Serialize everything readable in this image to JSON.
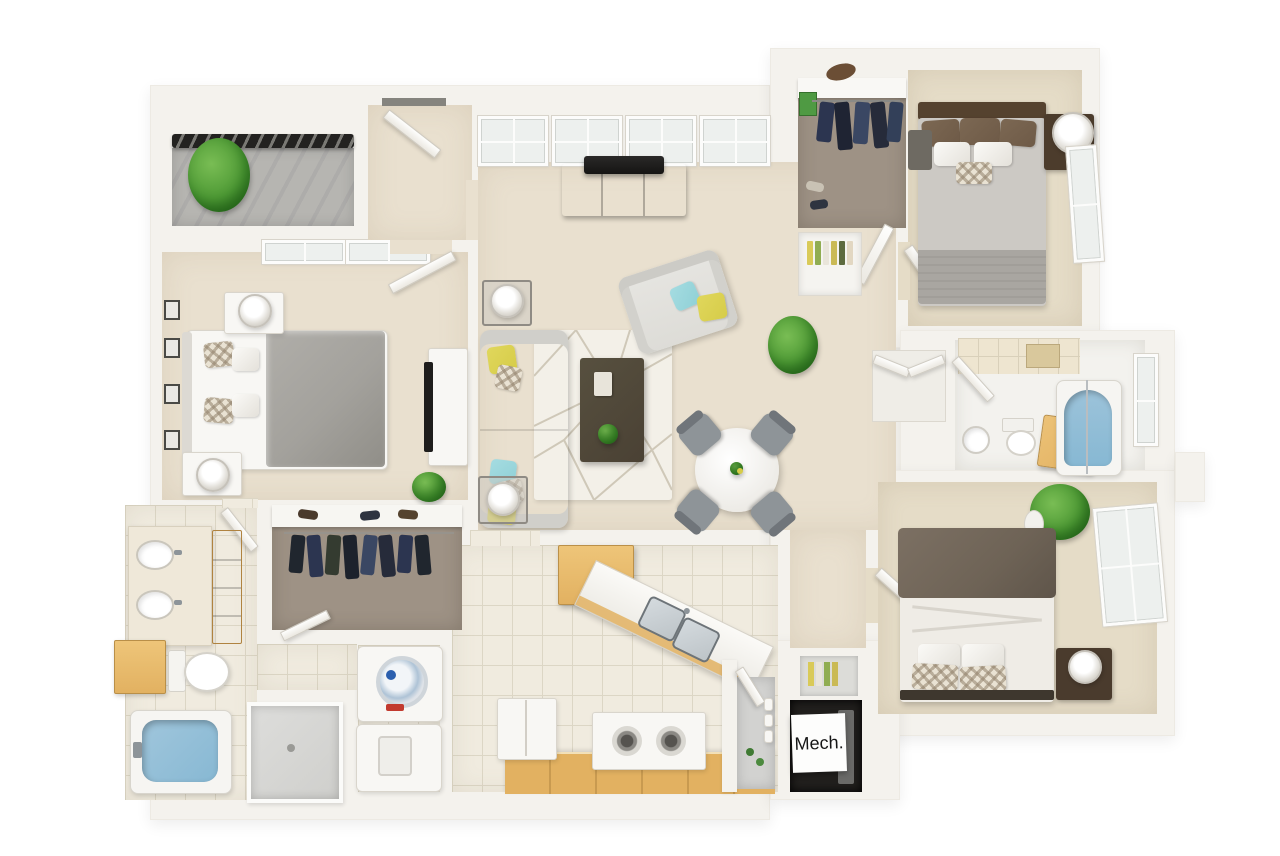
{
  "scene": {
    "type": "3d-apartment-floor-plan-rendering",
    "labels": {
      "mech_room": "Mech."
    },
    "rooms": [
      "balcony",
      "master-bedroom",
      "entry",
      "living-room",
      "dining-area",
      "kitchen",
      "pantry",
      "mechanical-room",
      "hallway",
      "laundry-closet",
      "master-bathroom",
      "master-walk-in-closet",
      "bedroom-2",
      "walk-in-closet-2",
      "bathroom-2",
      "bedroom-3"
    ],
    "furniture": [
      "king-bed",
      "queen-bed",
      "full-bed",
      "sofa",
      "loveseat",
      "coffee-table",
      "tv-console",
      "round-dining-table",
      "dining-chairs",
      "nightstands",
      "table-lamps",
      "double-vanity",
      "toilets",
      "bathtubs",
      "shower",
      "washer",
      "dryer",
      "refrigerator",
      "range-stove",
      "double-sink",
      "dining-plant",
      "potted-plants",
      "balcony-railing",
      "picture-frames",
      "area-rug",
      "bookshelf",
      "hanging-clothes"
    ]
  },
  "palette": {
    "wall": "#f4f2ed",
    "carpet": "#e9e0cf",
    "carpet2": "#e5dcc7",
    "tile": "#f0ebdf",
    "tileline": "#dcd6c5",
    "closetcarpet": "#9e9285",
    "balconyfloor": "#b3b2ae",
    "railing": "#232220",
    "green": "#4e9a35",
    "sofa": "#dddcd7",
    "yellow": "#d6cc49",
    "teal": "#8fd0d6",
    "wooddark": "#5d4935",
    "oak": "#e2b161",
    "coffee": "#4a4134",
    "steel": "#bdc4c8",
    "tub": "#87b8d3",
    "chair": "#8e9498",
    "bedgray": "#a3a19c",
    "taupe": "#6e6356",
    "brownpillow": "#6e5a47",
    "mechfloor": "#211f1d",
    "whitefurn": "#f8f7f4"
  }
}
